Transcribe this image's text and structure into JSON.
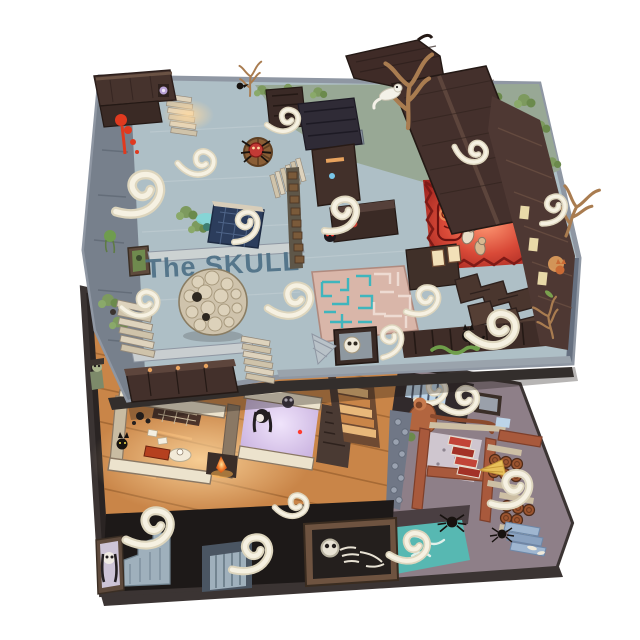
{
  "scene": {
    "title": "The SKULL",
    "board": "two-floor isometric haunted mansion game map",
    "palette": {
      "background": "#ffffff",
      "upper_floor_stone": "#aebfc6",
      "upper_wall_gray": "#77808c",
      "roof_dark": "#43302b",
      "moss_green": "#7d9a5e",
      "courtyard_green": "#98a895",
      "red_room": "#c0352c",
      "red_room_glow": "#ff8468",
      "maze_floor_pink": "#d9b6a9",
      "maze_teal": "#3fb5bd",
      "smoke_cream": "#f2ecdb",
      "skull_rock_bone": "#d6cab2",
      "title_color": "#4e7086",
      "wood_floor": "#c98548",
      "basement_black": "#1d1918",
      "dungeon_mauve": "#8e7f88",
      "terracotta_wall": "#a8593c",
      "barrel_brown": "#9c5530",
      "water_teal": "#57b8b2",
      "purple_room_glow": "#cdb7e2",
      "fire_orange": "#f07828",
      "blood_red": "#e03a1f"
    },
    "upper_floor": {
      "name": "ground floor",
      "features": [
        "stone courtyard",
        "red ritual room",
        "maze room",
        "skull boulder",
        "garden pond",
        "spider wheel",
        "blood splatter",
        "roofs with bare trees",
        "folding screens",
        "staircases",
        "skull in bed"
      ]
    },
    "lower_floor": {
      "name": "basement floor",
      "features": [
        "wooden parlor rooms",
        "fireplace",
        "ghost girl room",
        "grand staircase",
        "stone dungeon",
        "ape creature",
        "barrel cellar",
        "red stairs",
        "blue stairs",
        "teal flooded pool",
        "skeleton niche",
        "ghost portrait",
        "spiders"
      ]
    },
    "creatures": [
      "ghost smoke wisps",
      "red-eyed ghoul",
      "white mice heroes",
      "spider on wheel",
      "white ghost cat",
      "black cat",
      "green snake",
      "ape creature",
      "ghost girl",
      "skeleton",
      "spiders",
      "zombie maid"
    ]
  }
}
